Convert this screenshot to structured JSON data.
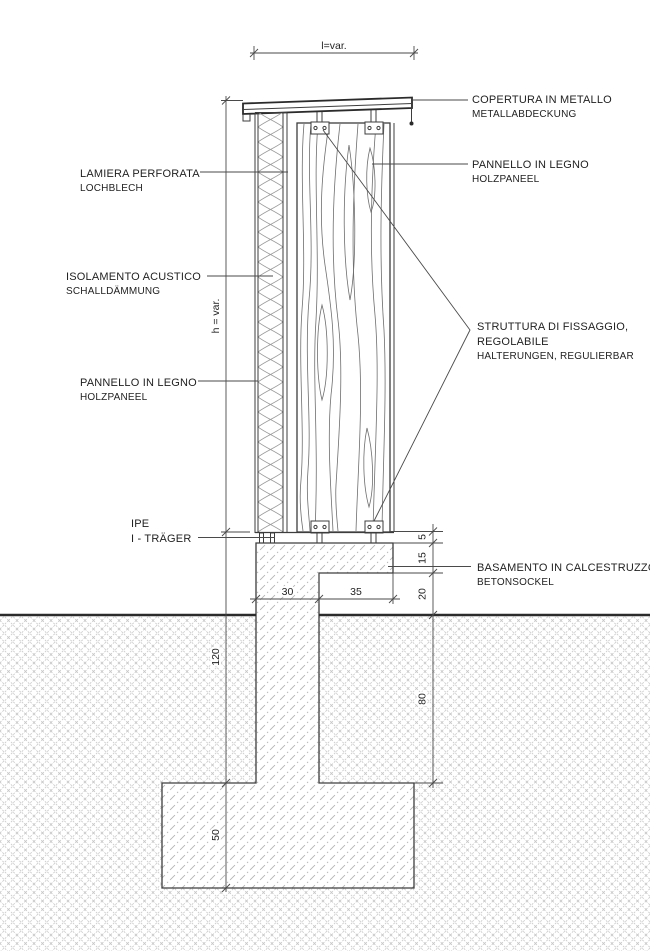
{
  "labels": {
    "copertura": {
      "it": "COPERTURA IN METALLO",
      "de": "METALLABDECKUNG"
    },
    "pannello_right": {
      "it": "PANNELLO IN LEGNO",
      "de": "HOLZPANEEL"
    },
    "struttura": {
      "it1": "STRUTTURA DI FISSAGGIO,",
      "it2": "REGOLABILE",
      "de": "HALTERUNGEN, REGULIERBAR"
    },
    "basamento": {
      "it": "BASAMENTO IN CALCESTRUZZO",
      "de": "BETONSOCKEL"
    },
    "lamiera": {
      "it": "LAMIERA PERFORATA",
      "de": "LOCHBLECH"
    },
    "isolamento": {
      "it": "ISOLAMENTO ACUSTICO",
      "de": "SCHALLDÄMMUNG"
    },
    "pannello_left": {
      "it": "PANNELLO IN LEGNO",
      "de": "HOLZPANEEL"
    },
    "ipe": {
      "it": "IPE",
      "de": "I - TRÄGER"
    }
  },
  "dimensions": {
    "width_top": "l=var.",
    "height": "h = var.",
    "left_chain": {
      "d120": "120",
      "d50": "50"
    },
    "right_chain": {
      "d5": "5",
      "d15": "15",
      "d20": "20",
      "d80": "80"
    },
    "base": {
      "d30": "30",
      "d35": "35"
    }
  },
  "colors": {
    "line": "#3d3d3d",
    "heavy": "#2b2b2b",
    "dim": "#4a4a4a",
    "text": "#1f1f1f",
    "grain": "#6e6e6e",
    "insul": "#9a9a9a",
    "earth": "#c7c7c7",
    "conc": "#b5b5b5",
    "bg": "#ffffff"
  }
}
